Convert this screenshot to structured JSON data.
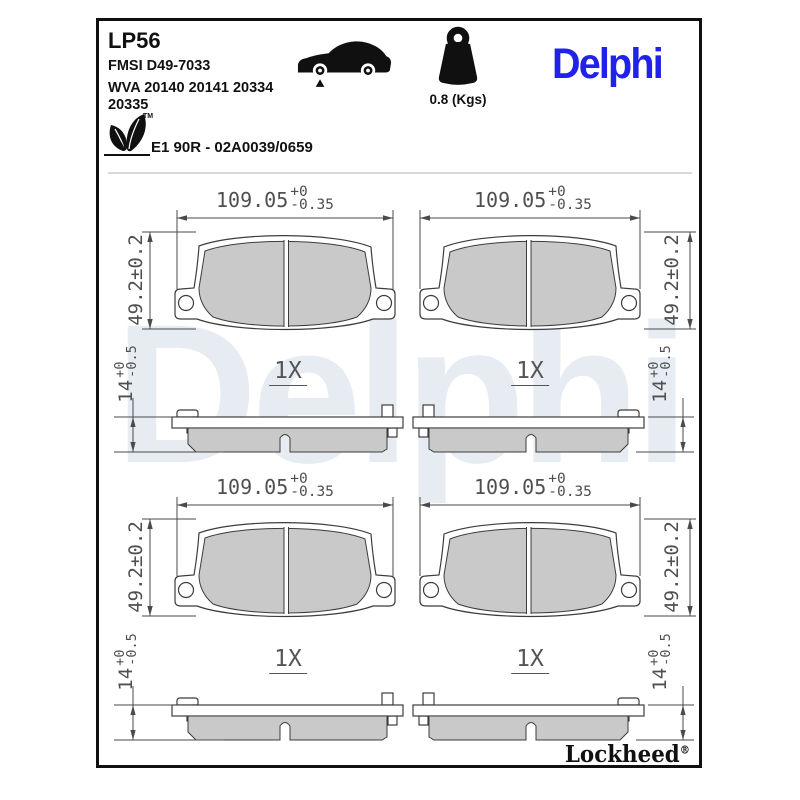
{
  "header": {
    "part_number": "LP56",
    "fmsi": "FMSI D49-7033",
    "wva_line1": "WVA 20140 20141 20334",
    "wva_line2": "20335",
    "weight_label": "0.8 (Kgs)",
    "brand_logo": "Delphi",
    "homologation": "E1 90R - 02A0039/0659",
    "leaf_tm": "TM",
    "leaf_axle": "N"
  },
  "icons": {
    "car": "car-side-front-axle-icon",
    "weight": "weight-kettlebell-icon",
    "leaf": "eco-leaf-icon"
  },
  "dimensions": {
    "width": {
      "nominal": "109.05",
      "tol_plus": "+0",
      "tol_minus": "-0.35"
    },
    "height": "49.2±0.2",
    "thickness": {
      "nominal": "14",
      "tol_plus": "+0",
      "tol_minus": "-0.5"
    },
    "quantity": "1X"
  },
  "watermark": "Delphi",
  "footer": {
    "brand": "Lockheed",
    "registered": "®"
  },
  "colors": {
    "brand_blue": "#2121ee",
    "friction_gray": "#c9c9c9",
    "drawing_line": "#3c3c3c",
    "dimension_text": "#4f4f4f",
    "watermark": "#e7ecf3"
  }
}
